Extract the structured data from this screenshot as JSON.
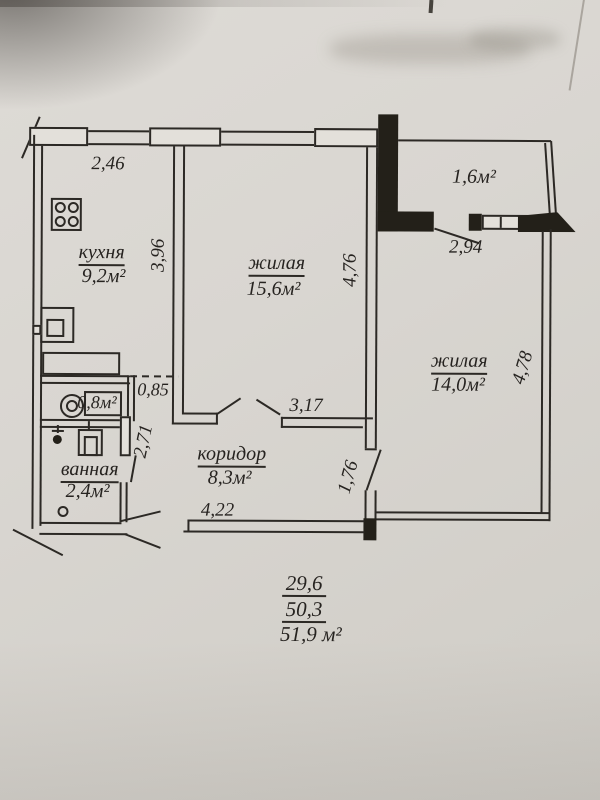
{
  "plan": {
    "rooms": {
      "kitchen": {
        "name": "кухня",
        "area": "9,2м²"
      },
      "living_1": {
        "name": "жилая",
        "area": "15,6м²"
      },
      "living_2": {
        "name": "жилая",
        "area": "14,0м²"
      },
      "corridor": {
        "name": "коридор",
        "area": "8,3м²"
      },
      "bathroom": {
        "name": "ванная",
        "area": "2,4м²"
      },
      "wc": {
        "area": "0,8м²"
      },
      "balcony": {
        "area": "1,6м²"
      }
    },
    "dimensions": {
      "kitchen_width": "2,46",
      "kitchen_depth": "3,96",
      "living1_depth": "4,76",
      "balcony_opening": "2,94",
      "living2_depth": "4,78",
      "wc_width": "0,85",
      "bathroom_depth": "2,71",
      "living1_entry": "3,17",
      "living2_entry": "1,76",
      "corridor_length": "4,22"
    },
    "area_summary": {
      "living_area": "29,6",
      "usable_area": "50,3",
      "total_area": "51,9 м²"
    },
    "fixtures": [
      "stove-icon",
      "sink-icon",
      "kitchen-counter",
      "toilet-icon",
      "shower-icon",
      "washing-machine-icon",
      "floor-drain-icon"
    ]
  }
}
